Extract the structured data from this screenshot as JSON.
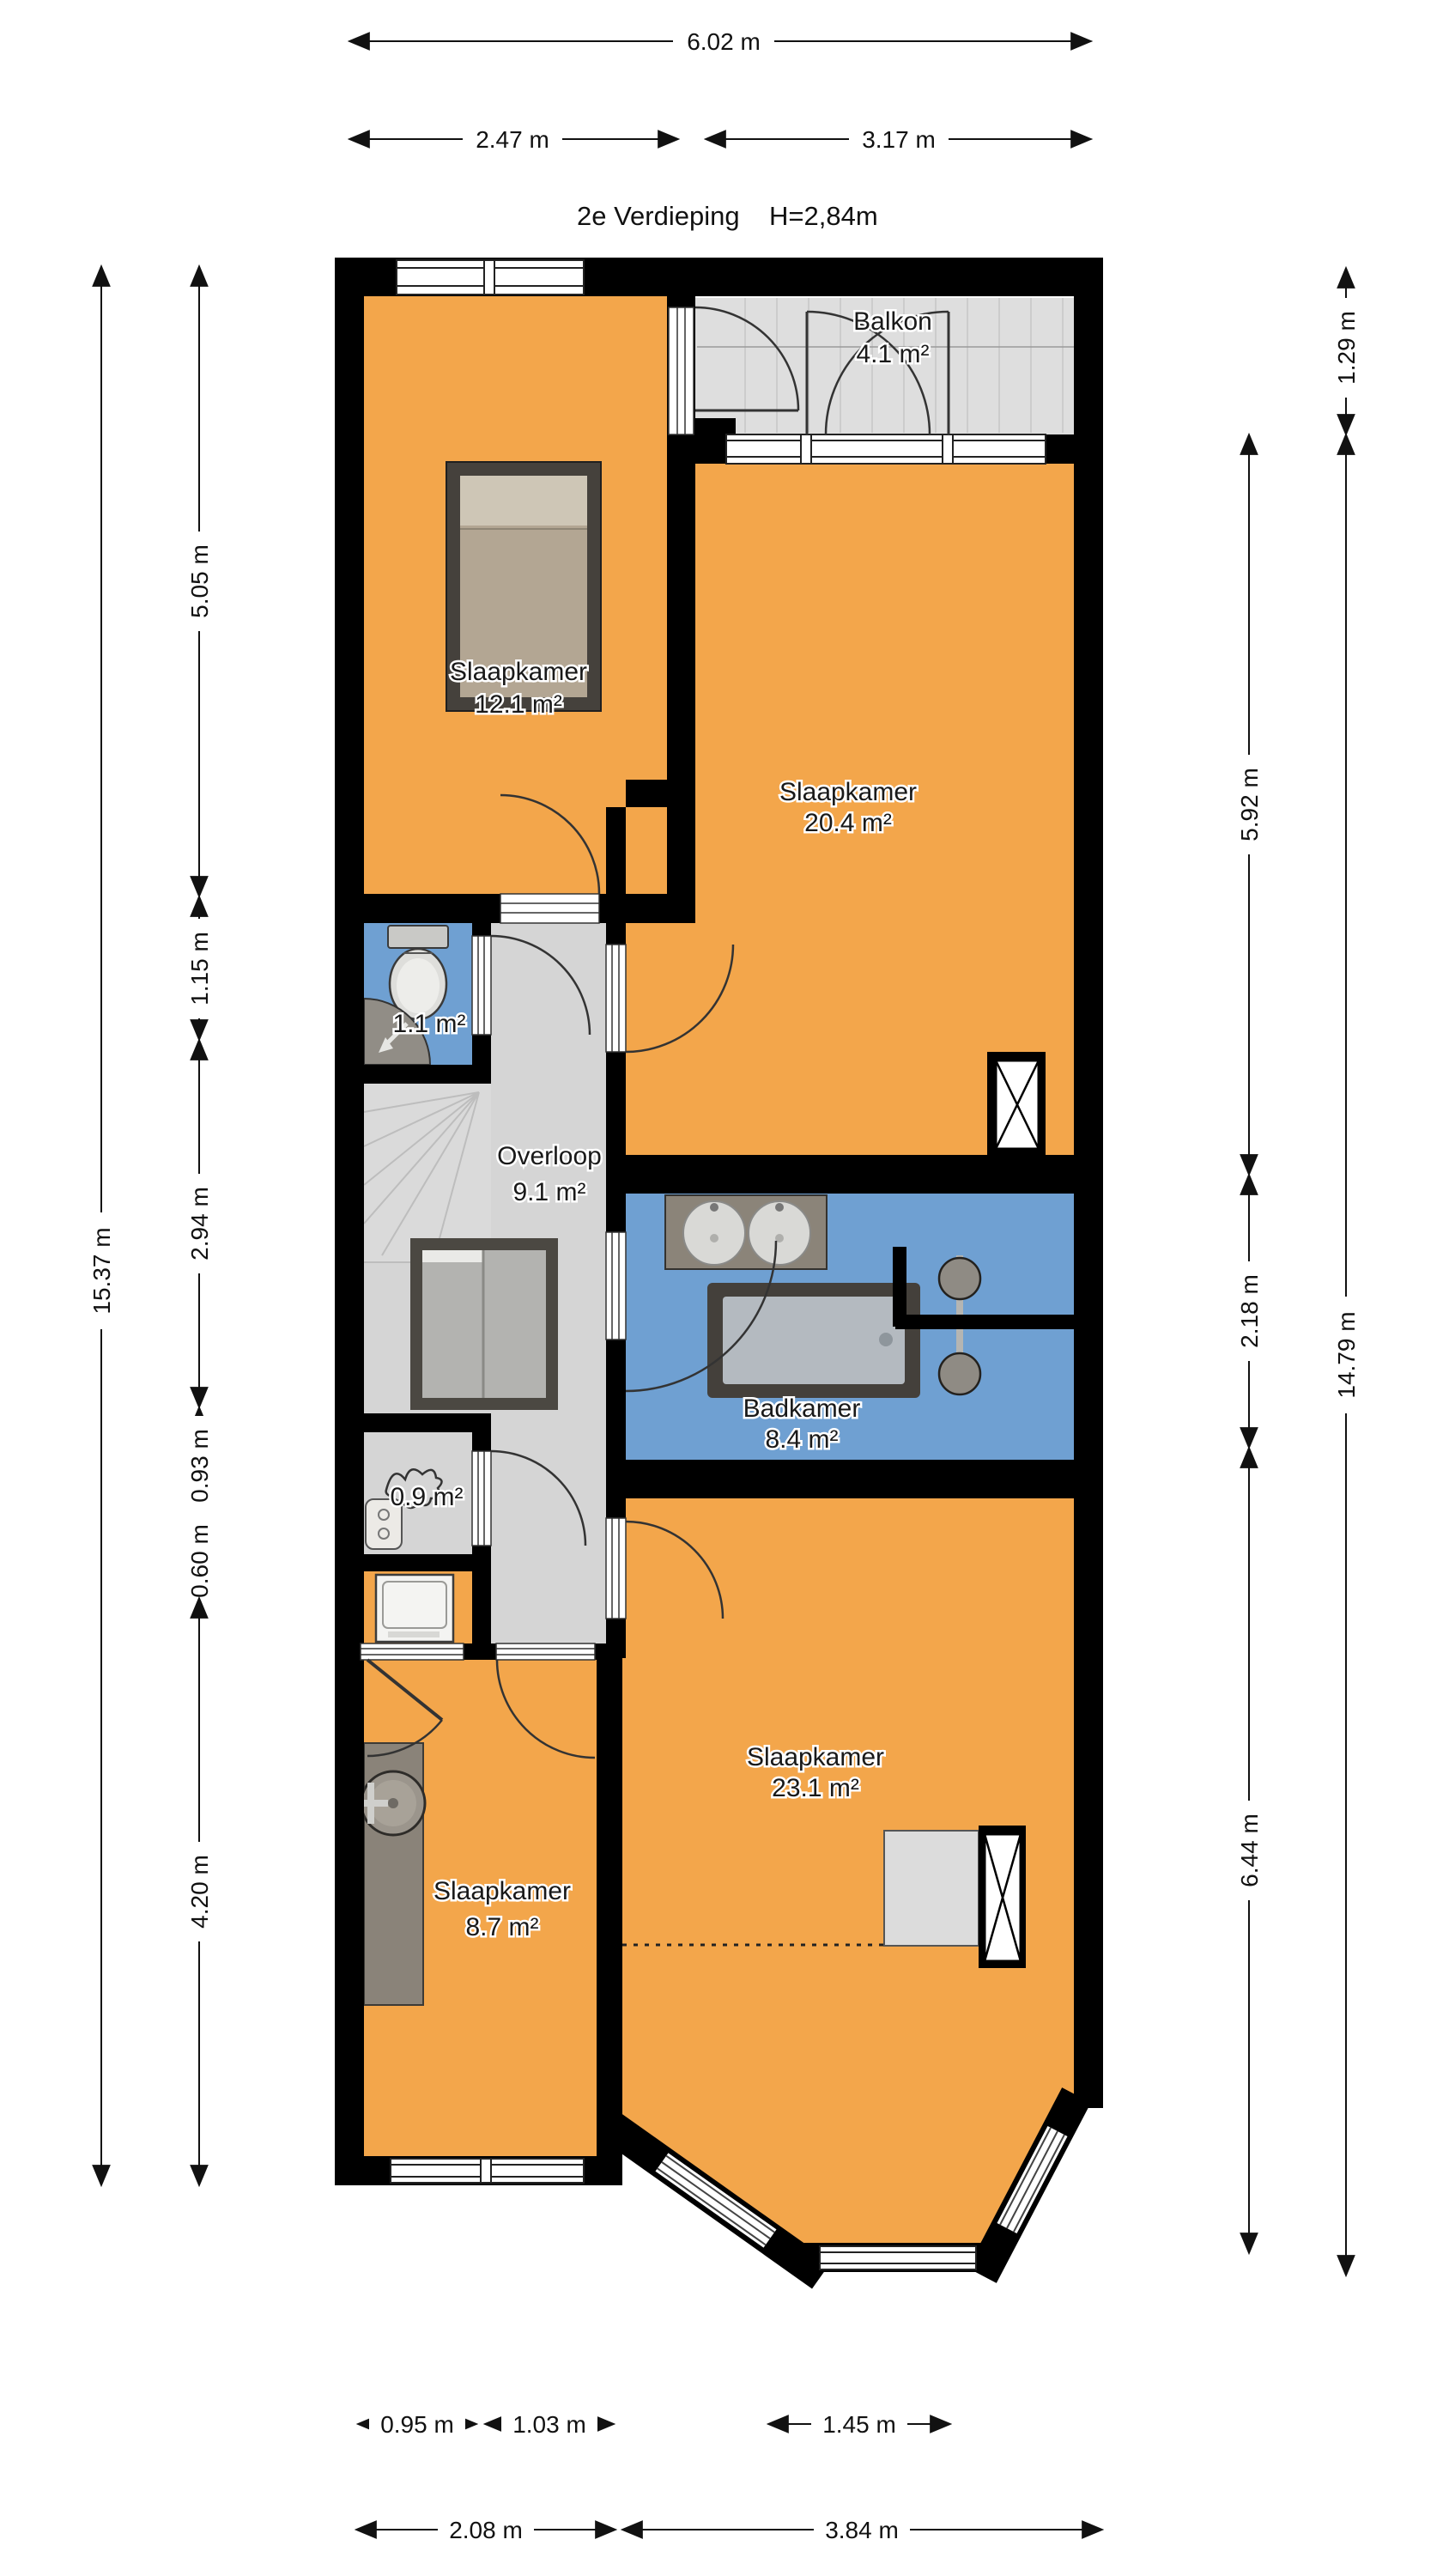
{
  "title": {
    "floor_label": "2e Verdieping",
    "ceiling_height": "H=2,84m"
  },
  "rooms": {
    "balkon": {
      "name": "Balkon",
      "area": "4.1 m²"
    },
    "slaapkamer_12": {
      "name": "Slaapkamer",
      "area": "12.1 m²"
    },
    "slaapkamer_20": {
      "name": "Slaapkamer",
      "area": "20.4 m²"
    },
    "toilet": {
      "area": "1.1 m²"
    },
    "overloop": {
      "name": "Overloop",
      "area": "9.1 m²"
    },
    "badkamer": {
      "name": "Badkamer",
      "area": "8.4 m²"
    },
    "kast": {
      "area": "0.9 m²"
    },
    "slaapkamer_23": {
      "name": "Slaapkamer",
      "area": "23.1 m²"
    },
    "slaapkamer_8": {
      "name": "Slaapkamer",
      "area": "8.7 m²"
    }
  },
  "dimensions": {
    "top": [
      "6.02 m",
      "2.47 m",
      "3.17 m"
    ],
    "left_overall": "15.37 m",
    "left": [
      "5.05 m",
      "1.15 m",
      "2.94 m",
      "0.93 m",
      "0.60 m",
      "4.20 m"
    ],
    "right": [
      "5.92 m",
      "2.18 m",
      "6.44 m"
    ],
    "right_outer": [
      "1.29 m",
      "14.79 m"
    ],
    "bottom_inner": [
      "0.95 m",
      "1.03 m",
      "1.45 m"
    ],
    "bottom": [
      "2.08 m",
      "3.84 m"
    ]
  },
  "colors": {
    "room_fill": "#F3A64B",
    "wet_room_fill": "#6FA0D2",
    "hall_fill": "#D5D5D5",
    "balcony_fill": "#DEDEDE",
    "wall": "#000000",
    "counter": "#8B8479"
  },
  "fixture_icons": [
    "bed-icon",
    "toilet-icon",
    "corner-shower-icon",
    "double-washbasin-icon",
    "bathtub-icon",
    "design-radiator-icon",
    "washing-machine-icon",
    "boiler-icon",
    "washbasin-icon",
    "stairs-icon",
    "glass-balustrade-icon",
    "ventilation-shaft-icon",
    "closet-icon",
    "sketch-icon"
  ]
}
